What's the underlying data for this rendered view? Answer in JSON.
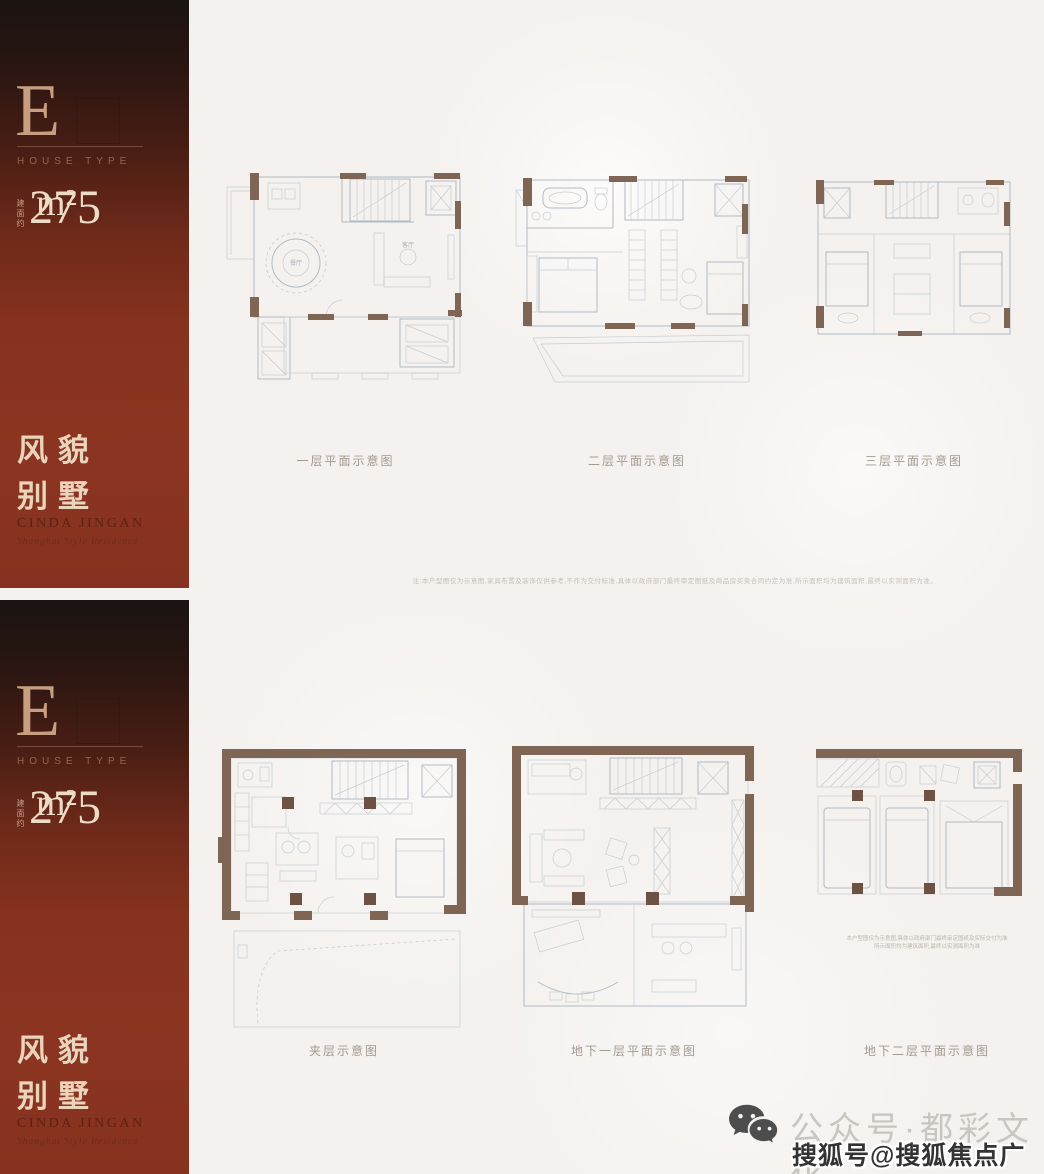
{
  "panels": [
    {
      "sidebar": {
        "type_letter": "E",
        "type_label": "HOUSE TYPE",
        "area_prefix": "建面约",
        "area_value": "275",
        "area_unit": "m²",
        "tagline_line1": "风貌",
        "tagline_line2": "别墅",
        "brand": "CINDA JINGAN",
        "brand_sub": "Shanghai Style Residence"
      },
      "plan_labels": [
        "一层平面示意图",
        "二层平面示意图",
        "三层平面示意图"
      ],
      "room_labels": {
        "dining": "餐厅",
        "living": "客厅"
      },
      "disclaimer": "注:本户型图仅为示意图,家具布置及装饰仅供参考,不作为交付标准,具体以政府部门最终审定图纸及商品房买卖合同约定为准,所示面积均为建筑面积,最终以实测面积为准。"
    },
    {
      "sidebar": {
        "type_letter": "E",
        "type_label": "HOUSE TYPE",
        "area_prefix": "建面约",
        "area_value": "275",
        "area_unit": "m²",
        "tagline_line1": "风貌",
        "tagline_line2": "别墅",
        "brand": "CINDA JINGAN",
        "brand_sub": "Shanghai Style Residence"
      },
      "plan_labels": [
        "夹层示意图",
        "地下一层平面示意图",
        "地下二层平面示意图"
      ],
      "plan_note_line1": "本户型图仅为示意图,具体以政府部门最终审定图纸及实际交付为准",
      "plan_note_line2": "所示面积均为建筑面积,最终以实测面积为准"
    }
  ],
  "watermarks": {
    "icon": "wechat-icon",
    "wechat_label": "公众号·都彩文化",
    "sohu_label": "搜狐号@搜狐焦点广安站"
  },
  "colors": {
    "sidebar_red": "#86321f",
    "sidebar_dark": "#1a1412",
    "accent_cream": "#ecdcc6",
    "wall_brown": "#7f6553",
    "plan_line": "#b2bbc4",
    "background": "#f4f1ee"
  }
}
